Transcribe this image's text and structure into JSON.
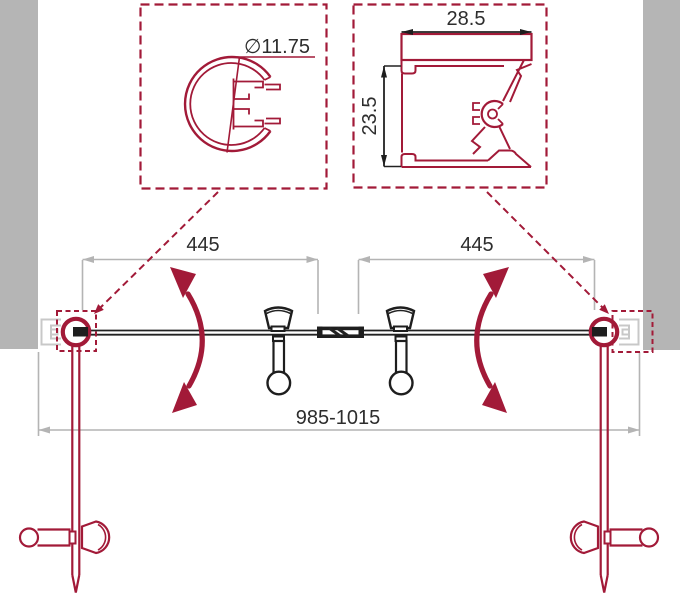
{
  "drawing": {
    "type": "technical-drawing",
    "subject": "double swing shower door, top view with profile callouts"
  },
  "colors": {
    "accent_red": "#a21a38",
    "wall_gray": "#b5b5b5",
    "profile_light_gray": "#c8c8c8",
    "dimension_gray": "#b4b4b4",
    "line_black": "#1e1e1e",
    "text": "#2d2d2d",
    "background": "#ffffff"
  },
  "callouts": {
    "pivot_profile": {
      "diameter_label": "∅11.75"
    },
    "wall_profile": {
      "width_label": "28.5",
      "depth_label": "23.5"
    }
  },
  "dimensions": {
    "left_door_width": "445",
    "right_door_width": "445",
    "overall_width": "985-1015"
  }
}
